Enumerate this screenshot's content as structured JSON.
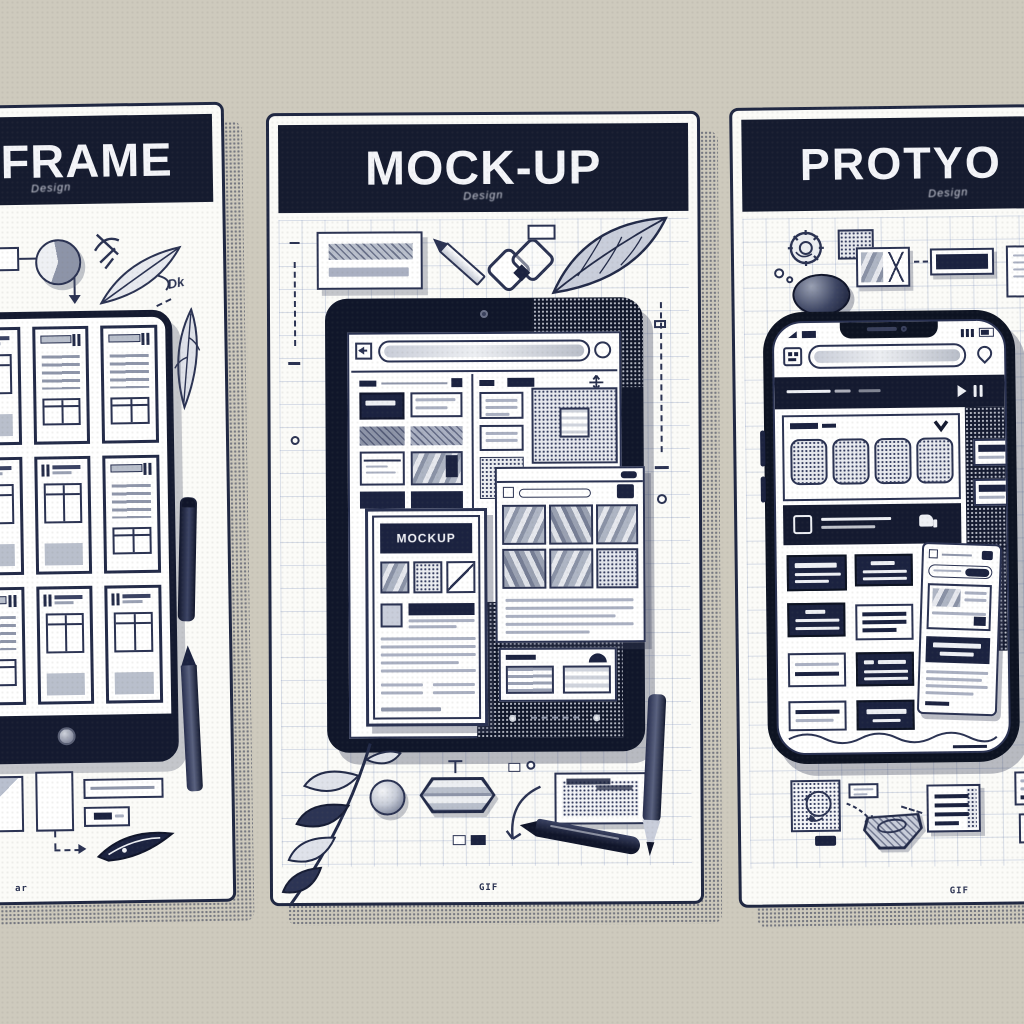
{
  "scene": {
    "background_color": "#cecabd",
    "ink_color": "#2a3252",
    "header_color": "#151b2f"
  },
  "panels": {
    "wireframe": {
      "title": "FRAME",
      "subtitle": "Design",
      "note": "Dk",
      "stamp": "ar"
    },
    "mockup": {
      "title": "MOCK-UP",
      "subtitle": "Design",
      "overlay_label": "MOCKUP",
      "stamp": "GIF"
    },
    "prototype": {
      "title": "PROTYO",
      "subtitle": "Design",
      "stamp": "GIF"
    }
  }
}
